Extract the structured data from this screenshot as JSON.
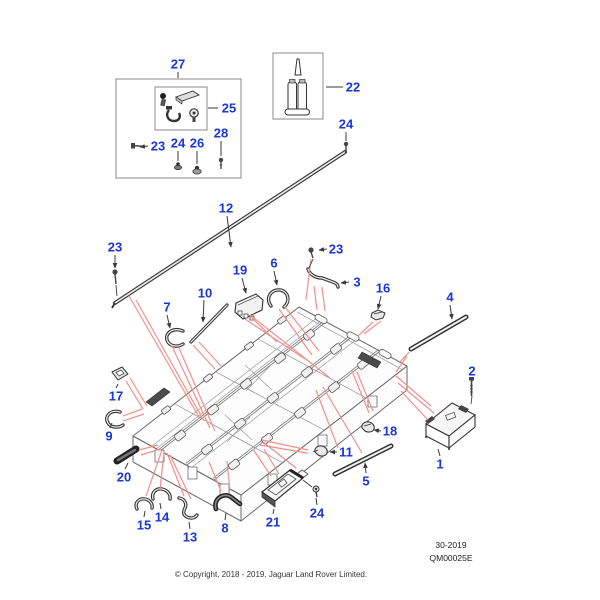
{
  "footer": {
    "sheet_code": "30-2019",
    "drawing_code": "QM00025E",
    "copyright": "© Copyright, 2018 - 2019. Jaguar Land Rover Limited."
  },
  "colors": {
    "label": "#1a36d8",
    "leader": "#3a3a3a",
    "assembly_line": "#f1908b"
  },
  "callouts": [
    {
      "n": "27",
      "x": 178,
      "y": 64,
      "leader": [
        178,
        72,
        178,
        78
      ],
      "arrow": false
    },
    {
      "n": "25",
      "x": 229,
      "y": 108,
      "leader": [
        208,
        108,
        218,
        108
      ],
      "arrow": false
    },
    {
      "n": "23",
      "x": 158,
      "y": 146,
      "leader": [
        148,
        146,
        140,
        147
      ],
      "arrow": true
    },
    {
      "n": "24",
      "x": 178,
      "y": 143,
      "leader": [
        178,
        151,
        178,
        161
      ],
      "arrow": false
    },
    {
      "n": "26",
      "x": 197,
      "y": 143,
      "leader": [
        197,
        151,
        197,
        164
      ],
      "arrow": false
    },
    {
      "n": "28",
      "x": 221,
      "y": 133,
      "leader": [
        221,
        141,
        221,
        156
      ],
      "arrow": false
    },
    {
      "n": "22",
      "x": 353,
      "y": 87,
      "leader": [
        343,
        87,
        326,
        87
      ],
      "arrow": false
    },
    {
      "n": "24",
      "x": 346,
      "y": 124,
      "leader": [
        346,
        132,
        346,
        141
      ],
      "arrow": false
    },
    {
      "n": "12",
      "x": 226,
      "y": 208,
      "leader": [
        227,
        216,
        231,
        247
      ],
      "arrow": true
    },
    {
      "n": "23",
      "x": 115,
      "y": 247,
      "leader": [
        115,
        255,
        115,
        268
      ],
      "arrow": true
    },
    {
      "n": "23",
      "x": 336,
      "y": 249,
      "leader": [
        327,
        249,
        319,
        250
      ],
      "arrow": true
    },
    {
      "n": "3",
      "x": 357,
      "y": 282,
      "leader": [
        349,
        282,
        341,
        283
      ],
      "arrow": true
    },
    {
      "n": "6",
      "x": 274,
      "y": 263,
      "leader": [
        274,
        271,
        277,
        285
      ],
      "arrow": true
    },
    {
      "n": "19",
      "x": 240,
      "y": 270,
      "leader": [
        242,
        278,
        246,
        293
      ],
      "arrow": true
    },
    {
      "n": "10",
      "x": 205,
      "y": 293,
      "leader": [
        204,
        300,
        203,
        322
      ],
      "arrow": true
    },
    {
      "n": "7",
      "x": 167,
      "y": 307,
      "leader": [
        167,
        315,
        170,
        328
      ],
      "arrow": true
    },
    {
      "n": "16",
      "x": 383,
      "y": 288,
      "leader": [
        381,
        296,
        378,
        309
      ],
      "arrow": true
    },
    {
      "n": "4",
      "x": 450,
      "y": 297,
      "leader": [
        450,
        305,
        452,
        319
      ],
      "arrow": true
    },
    {
      "n": "2",
      "x": 472,
      "y": 371,
      "leader": [
        472,
        378,
        472,
        382
      ],
      "arrow": false
    },
    {
      "n": "1",
      "x": 440,
      "y": 464,
      "leader": [
        440,
        456,
        438,
        449
      ],
      "arrow": false
    },
    {
      "n": "18",
      "x": 390,
      "y": 431,
      "leader": [
        381,
        431,
        374,
        430
      ],
      "arrow": true
    },
    {
      "n": "11",
      "x": 346,
      "y": 452,
      "leader": [
        337,
        452,
        330,
        452
      ],
      "arrow": true
    },
    {
      "n": "5",
      "x": 366,
      "y": 481,
      "leader": [
        366,
        473,
        365,
        463
      ],
      "arrow": true
    },
    {
      "n": "17",
      "x": 116,
      "y": 396,
      "leader": [
        116,
        388,
        118,
        384
      ],
      "arrow": false
    },
    {
      "n": "9",
      "x": 109,
      "y": 436,
      "leader": [
        110,
        428,
        112,
        423
      ],
      "arrow": false
    },
    {
      "n": "20",
      "x": 124,
      "y": 477,
      "leader": [
        125,
        469,
        128,
        463
      ],
      "arrow": false
    },
    {
      "n": "15",
      "x": 144,
      "y": 525,
      "leader": [
        144,
        517,
        145,
        511
      ],
      "arrow": false
    },
    {
      "n": "14",
      "x": 162,
      "y": 517,
      "leader": [
        161,
        509,
        160,
        503
      ],
      "arrow": false
    },
    {
      "n": "13",
      "x": 190,
      "y": 537,
      "leader": [
        190,
        529,
        189,
        522
      ],
      "arrow": false
    },
    {
      "n": "8",
      "x": 225,
      "y": 528,
      "leader": [
        225,
        520,
        226,
        513
      ],
      "arrow": false
    },
    {
      "n": "21",
      "x": 273,
      "y": 522,
      "leader": [
        273,
        514,
        274,
        509
      ],
      "arrow": false
    },
    {
      "n": "24",
      "x": 317,
      "y": 513,
      "leader": [
        317,
        505,
        316,
        498
      ],
      "arrow": false
    }
  ],
  "assembly_lines": [
    [
      129,
      296,
      199,
      417
    ],
    [
      136,
      300,
      204,
      421
    ],
    [
      172,
      346,
      210,
      428
    ],
    [
      179,
      348,
      215,
      431
    ],
    [
      193,
      345,
      215,
      369
    ],
    [
      199,
      342,
      221,
      366
    ],
    [
      245,
      319,
      305,
      359
    ],
    [
      251,
      317,
      277,
      342
    ],
    [
      250,
      315,
      330,
      378
    ],
    [
      279,
      309,
      312,
      355
    ],
    [
      285,
      307,
      319,
      351
    ],
    [
      314,
      286,
      317,
      310
    ],
    [
      322,
      287,
      325,
      311
    ],
    [
      311,
      259,
      306,
      300
    ],
    [
      373,
      322,
      358,
      336
    ],
    [
      381,
      321,
      364,
      334
    ],
    [
      409,
      352,
      399,
      363
    ],
    [
      407,
      356,
      396,
      372
    ],
    [
      395,
      375,
      431,
      406
    ],
    [
      398,
      383,
      434,
      413
    ],
    [
      401,
      391,
      428,
      420
    ],
    [
      352,
      371,
      369,
      413
    ],
    [
      357,
      372,
      373,
      411
    ],
    [
      308,
      450,
      262,
      440
    ],
    [
      307,
      453,
      260,
      445
    ],
    [
      323,
      387,
      362,
      453
    ],
    [
      316,
      390,
      338,
      448
    ],
    [
      126,
      381,
      143,
      409
    ],
    [
      130,
      378,
      147,
      406
    ],
    [
      123,
      416,
      142,
      409
    ],
    [
      123,
      421,
      144,
      414
    ],
    [
      139,
      450,
      158,
      445
    ],
    [
      141,
      455,
      160,
      449
    ],
    [
      162,
      450,
      146,
      496
    ],
    [
      164,
      452,
      160,
      490
    ],
    [
      167,
      453,
      184,
      496
    ],
    [
      170,
      455,
      191,
      499
    ],
    [
      221,
      491,
      209,
      462
    ],
    [
      230,
      491,
      227,
      461
    ],
    [
      271,
      476,
      253,
      449
    ],
    [
      279,
      474,
      264,
      449
    ],
    [
      263,
      442,
      296,
      468
    ]
  ],
  "connector_lines": [
    [
      313,
      259,
      309,
      268
    ],
    [
      303,
      480,
      312,
      487
    ],
    [
      472,
      396,
      471,
      404
    ],
    [
      346,
      150,
      345,
      154
    ],
    [
      116,
      285,
      117,
      296
    ]
  ]
}
